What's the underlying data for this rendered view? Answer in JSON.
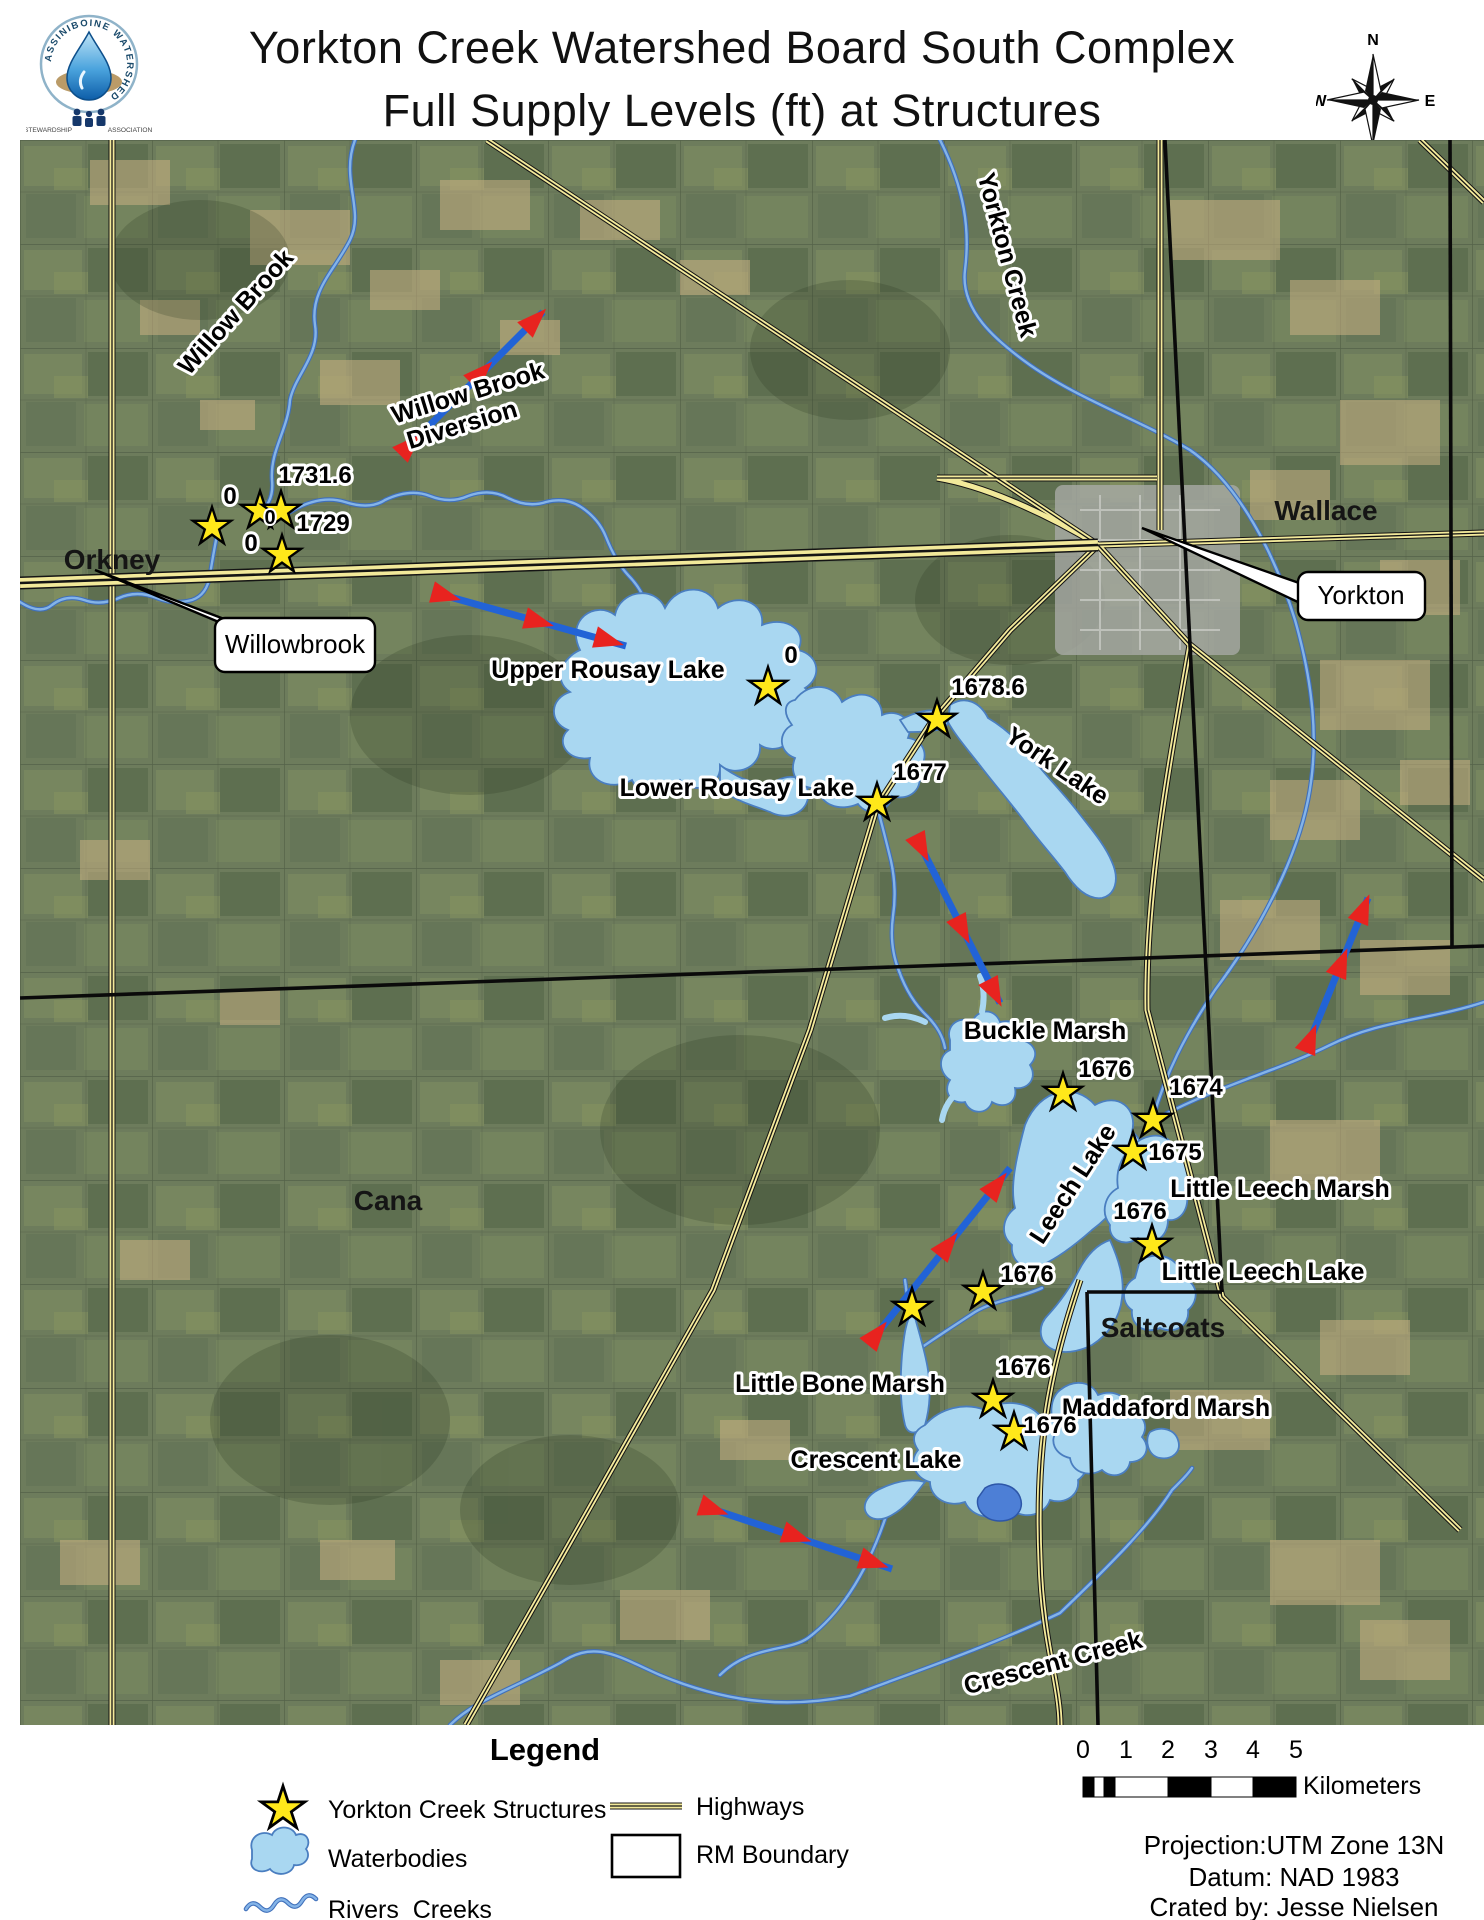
{
  "header": {
    "title_line1": "Yorkton Creek Watershed Board South Complex",
    "title_line2": "Full Supply Levels (ft) at Structures"
  },
  "logo": {
    "ring_text": "ASSINIBOINE WATERSHED",
    "banner_left": "STEWARDSHIP",
    "banner_right": "ASSOCIATION"
  },
  "compass": {
    "north": "N",
    "east": "E",
    "south": "S",
    "west": "W"
  },
  "map": {
    "place_labels": [
      "Orkney",
      "Wallace",
      "Cana",
      "Saltcoats"
    ],
    "water_labels": [
      "Willow Brook",
      "Willow Brook",
      "Diversion",
      "Upper Rousay Lake",
      "Lower Rousay Lake",
      "York Lake",
      "Yorkton Creek",
      "Buckle Marsh",
      "Leech Lake",
      "Little Leech Marsh",
      "Little Leech Lake",
      "Little Bone Marsh",
      "Crescent Lake",
      "Maddaford Marsh",
      "Crescent Creek"
    ],
    "callouts": [
      "Willowbrook",
      "Yorkton"
    ],
    "structure_values": [
      "0",
      "1731.6",
      "0",
      "1729",
      "0",
      "0",
      "1678.6",
      "1677",
      "1676",
      "1674",
      "1675",
      "1676",
      "1676",
      "1676",
      "1676"
    ]
  },
  "legend": {
    "title": "Legend",
    "items": [
      "Yorkton Creek Structures",
      "Waterbodies",
      "Rivers_Creeks",
      "Highways",
      "RM Boundary"
    ]
  },
  "scalebar": {
    "ticks": [
      "0",
      "1",
      "2",
      "3",
      "4",
      "5"
    ],
    "unit": "Kilometers"
  },
  "credits": {
    "projection": "Projection:UTM Zone 13N",
    "datum": "Datum: NAD 1983",
    "created_by": "Crated by: Jesse Nielsen"
  },
  "colors": {
    "water": "#A9D7F1",
    "water_stroke": "#4A7EC0",
    "highway_fill": "#F2E99A",
    "star_fill": "#FFE81A",
    "arrow_line": "#2263D6",
    "arrow_head": "#E8231F"
  }
}
